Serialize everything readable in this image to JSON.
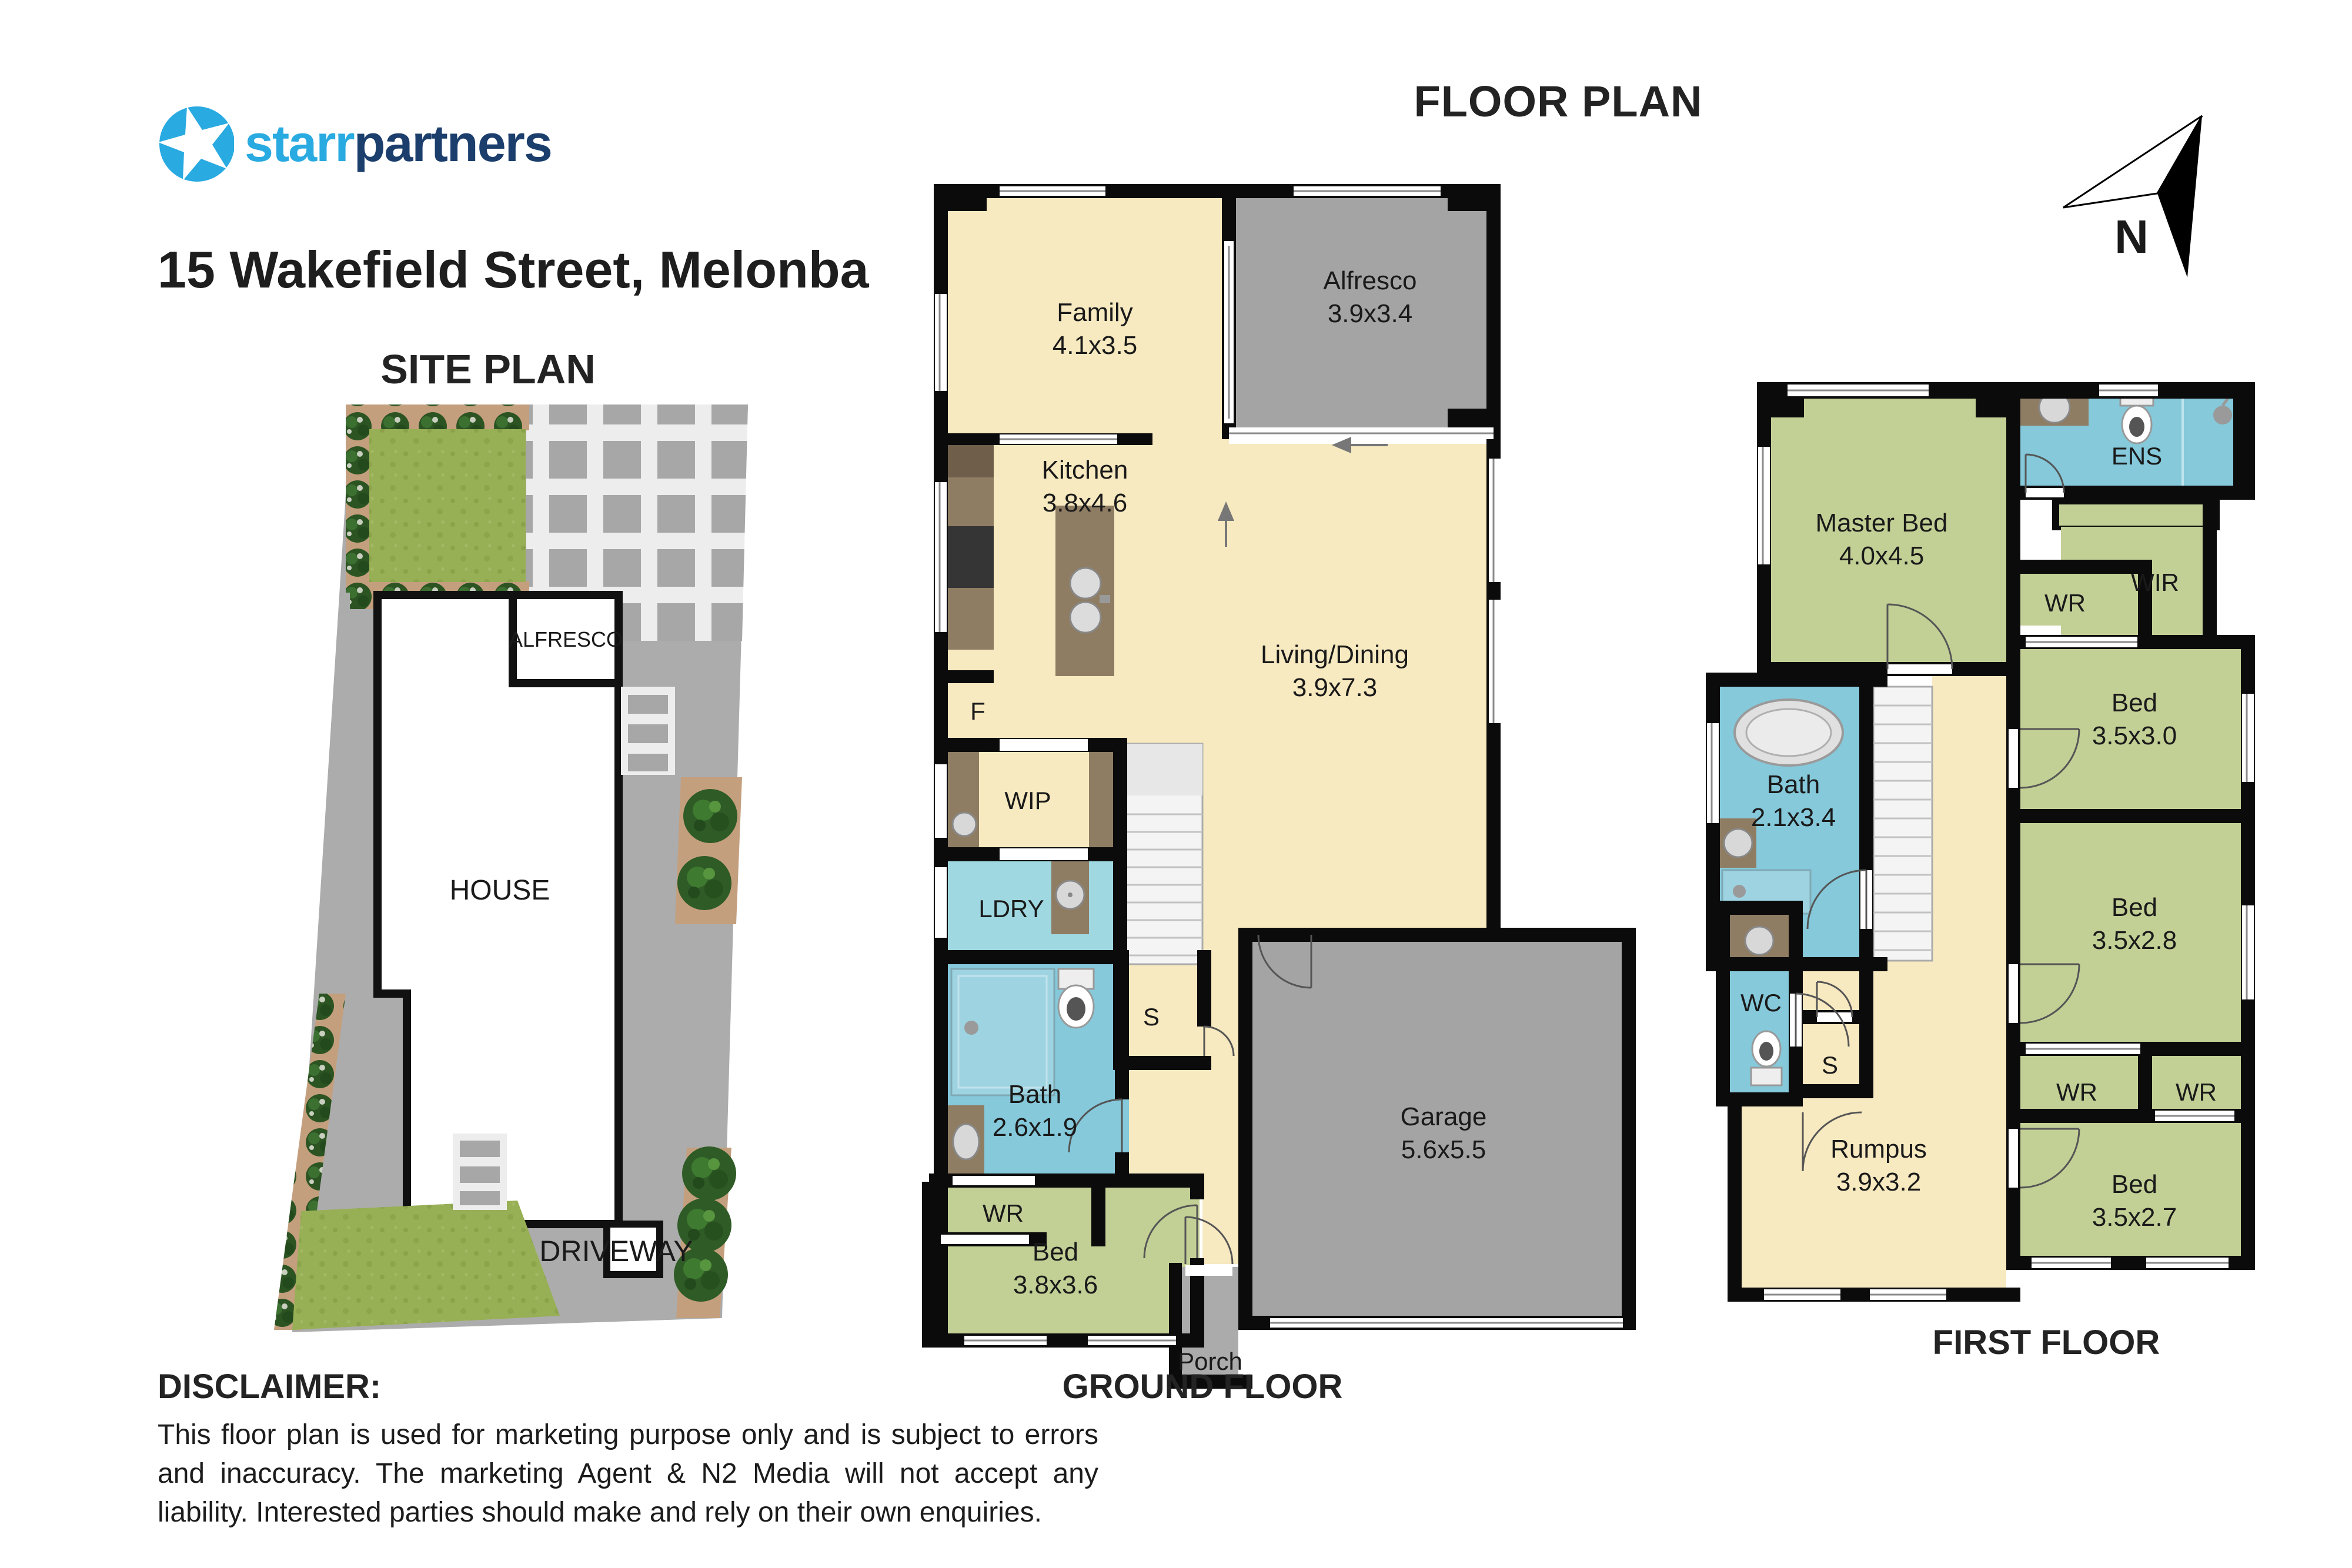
{
  "header": {
    "brand_star": "starr",
    "brand_partners": "partners",
    "title": "15 Wakefield Street, Melonba",
    "floor_plan_heading": "FLOOR PLAN",
    "site_plan_heading": "SITE PLAN",
    "north_label": "N"
  },
  "site_plan": {
    "alfresco_label": "ALFRESCO",
    "house_label": "HOUSE",
    "driveway_label": "DRIVEWAY"
  },
  "ground_floor": {
    "caption": "GROUND FLOOR",
    "rooms": {
      "family": {
        "name": "Family",
        "dims": "4.1x3.5"
      },
      "alfresco": {
        "name": "Alfresco",
        "dims": "3.9x3.4"
      },
      "kitchen": {
        "name": "Kitchen",
        "dims": "3.8x4.6"
      },
      "living": {
        "name": "Living/Dining",
        "dims": "3.9x7.3"
      },
      "bath": {
        "name": "Bath",
        "dims": "2.6x1.9"
      },
      "bed": {
        "name": "Bed",
        "dims": "3.8x3.6"
      },
      "garage": {
        "name": "Garage",
        "dims": "5.6x5.5"
      }
    },
    "labels": {
      "fridge": "F",
      "wip": "WIP",
      "ldry": "LDRY",
      "store": "S",
      "wr": "WR",
      "porch": "Porch"
    }
  },
  "first_floor": {
    "caption": "FIRST FLOOR",
    "rooms": {
      "master": {
        "name": "Master Bed",
        "dims": "4.0x4.5"
      },
      "bath": {
        "name": "Bath",
        "dims": "2.1x3.4"
      },
      "bed1": {
        "name": "Bed",
        "dims": "3.5x3.0"
      },
      "bed2": {
        "name": "Bed",
        "dims": "3.5x2.8"
      },
      "bed3": {
        "name": "Bed",
        "dims": "3.5x2.7"
      },
      "rumpus": {
        "name": "Rumpus",
        "dims": "3.9x3.2"
      }
    },
    "labels": {
      "ens": "ENS",
      "wir": "WIR",
      "wr_master": "WR",
      "wc": "WC",
      "store": "S",
      "wr_left": "WR",
      "wr_right": "WR"
    }
  },
  "disclaimer": {
    "heading": "DISCLAIMER:",
    "body": "This floor plan is used for marketing purpose only and is subject to errors and inaccuracy. The marketing Agent & N2 Media will not accept any liability. Interested parties should make and rely on their own enquiries."
  },
  "colors": {
    "brand_light": "#29AAE1",
    "brand_dark": "#1B3E6C",
    "floor_cream": "#F7E9C0",
    "room_green": "#C2D096",
    "wet_blue": "#85C9DB",
    "hard_gray": "#A6A6A6",
    "bench_brown": "#8F7D63",
    "wall_black": "#0B0B0B"
  }
}
